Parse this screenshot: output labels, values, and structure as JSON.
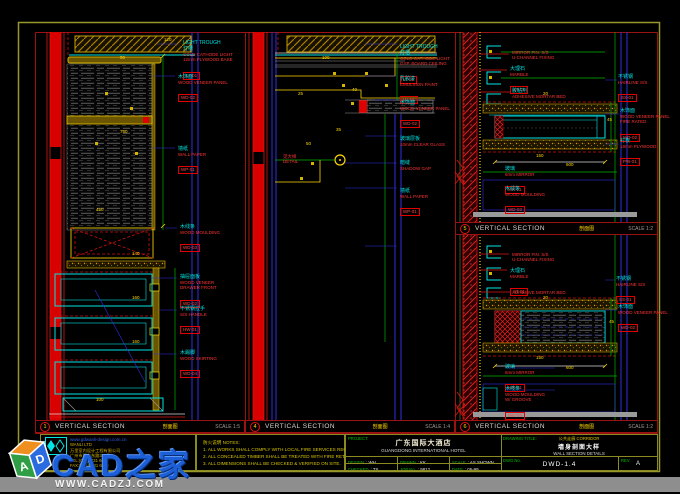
{
  "sheet": {
    "border_color": "#97972a",
    "separator_color": "#9b1212",
    "accent_red": "#e01414",
    "accent_cyan": "#00e5e5",
    "accent_yellow": "#ffd700",
    "accent_blue": "#2f2fe6"
  },
  "panels": [
    {
      "id": "1",
      "title": "VERTICAL SECTION",
      "subtitle": "剖面图",
      "scale": "SCALE 1:5",
      "callouts": [
        {
          "x": 183,
          "y": 40,
          "t": "LIGHT TROUGH\n灯槽",
          "r": "COLD CATHODE LIGHT\n12mm PLYWOOD BASE",
          "code": "LT-01"
        },
        {
          "x": 178,
          "y": 74,
          "t": "木饰面",
          "r": "WOOD VENEER PANEL",
          "code": "WD-02"
        },
        {
          "x": 178,
          "y": 146,
          "t": "墙纸",
          "r": "WALL PAPER",
          "code": "WP-01"
        },
        {
          "x": 180,
          "y": 224,
          "t": "木线条",
          "r": "WOOD MOULDING",
          "code": "WD-03"
        },
        {
          "x": 180,
          "y": 274,
          "t": "抽屉面板",
          "r": "WOOD VENEER\nDRAWER FRONT",
          "code": "WD-02"
        },
        {
          "x": 180,
          "y": 306,
          "t": "不锈钢拉手",
          "r": "S/S HANDLE",
          "code": "HW-01"
        },
        {
          "x": 180,
          "y": 350,
          "t": "木踢脚",
          "r": "WOOD SKIRTING",
          "code": "WD-04"
        }
      ],
      "dims": [
        {
          "x": 120,
          "y": 56,
          "v": "50"
        },
        {
          "x": 120,
          "y": 130,
          "v": "750"
        },
        {
          "x": 164,
          "y": 38,
          "v": "120"
        },
        {
          "x": 96,
          "y": 208,
          "v": "450"
        },
        {
          "x": 132,
          "y": 252,
          "v": "140"
        },
        {
          "x": 132,
          "y": 296,
          "v": "160"
        },
        {
          "x": 132,
          "y": 340,
          "v": "160"
        },
        {
          "x": 96,
          "y": 398,
          "v": "100"
        }
      ]
    },
    {
      "id": "4",
      "title": "VERTICAL SECTION",
      "subtitle": "剖面图",
      "scale": "SCALE 1:4",
      "callouts": [
        {
          "x": 400,
          "y": 44,
          "t": "LIGHT TROUGH\n灯槽",
          "r": "COLD CATHODE LIGHT\nGYP. BOARD CEILING",
          "code": "LT-01"
        },
        {
          "x": 400,
          "y": 76,
          "t": "乳胶漆",
          "r": "EMULSION PAINT",
          "code": "PT-01"
        },
        {
          "x": 400,
          "y": 100,
          "t": "木饰面",
          "r": "WOOD VENEER PANEL",
          "code": "WD-02"
        },
        {
          "x": 400,
          "y": 136,
          "t": "玻璃层板",
          "r": "10mm CLEAR GLASS"
        },
        {
          "x": 400,
          "y": 160,
          "t": "暗缝",
          "r": "SHADOW GAP"
        },
        {
          "x": 400,
          "y": 188,
          "t": "墙纸",
          "r": "WALL PAPER",
          "code": "WP-01"
        },
        {
          "x": 283,
          "y": 154,
          "r": "见大样\nDETAIL"
        }
      ],
      "dims": [
        {
          "x": 298,
          "y": 92,
          "v": "25"
        },
        {
          "x": 322,
          "y": 56,
          "v": "100"
        },
        {
          "x": 352,
          "y": 88,
          "v": "40"
        },
        {
          "x": 336,
          "y": 128,
          "v": "35"
        },
        {
          "x": 306,
          "y": 142,
          "v": "50"
        }
      ]
    },
    {
      "id": "5",
      "title": "VERTICAL SECTION",
      "subtitle": "剖面图",
      "scale": "SCALE 1:2",
      "callouts": [
        {
          "x": 512,
          "y": 50,
          "r": "MIRROR FIN. S/S\nU-CHANNEL FIXING"
        },
        {
          "x": 510,
          "y": 66,
          "t": "大理石",
          "r": "MARBLE",
          "code": "ST-01"
        },
        {
          "x": 512,
          "y": 88,
          "t": "胶粘剂",
          "r": "ADHESIVE MORTAR BED"
        },
        {
          "x": 618,
          "y": 74,
          "t": "不锈钢",
          "r": "HAIRLINE S/S",
          "code": "SS-01"
        },
        {
          "x": 620,
          "y": 108,
          "t": "木饰面",
          "r": "WOOD VENEER PANEL\nFIRE RATED",
          "code": "WD-02"
        },
        {
          "x": 620,
          "y": 138,
          "t": "衬板",
          "r": "18mm PLYWOOD",
          "code": "PW-01"
        },
        {
          "x": 505,
          "y": 166,
          "t": "玻璃",
          "r": "6mm MIRROR",
          "code": "MR-01"
        },
        {
          "x": 505,
          "y": 186,
          "t": "木线条",
          "r": "WOOD MOULDING",
          "code": "WD-03"
        }
      ],
      "dims": [
        {
          "x": 536,
          "y": 154,
          "v": "150"
        },
        {
          "x": 566,
          "y": 163,
          "v": "600"
        },
        {
          "x": 607,
          "y": 118,
          "v": "45"
        },
        {
          "x": 543,
          "y": 92,
          "v": "20"
        }
      ]
    },
    {
      "id": "6",
      "title": "VERTICAL SECTION",
      "subtitle": "剖面图",
      "scale": "SCALE 1:2",
      "callouts": [
        {
          "x": 512,
          "y": 252,
          "r": "MIRROR FIN. S/S\nU-CHANNEL FIXING"
        },
        {
          "x": 510,
          "y": 268,
          "t": "大理石",
          "r": "MARBLE",
          "code": "ST-01"
        },
        {
          "x": 512,
          "y": 290,
          "r": "ADHESIVE MORTAR BED"
        },
        {
          "x": 616,
          "y": 276,
          "t": "不锈钢",
          "r": "HAIRLINE S/S",
          "code": "SS-01"
        },
        {
          "x": 618,
          "y": 304,
          "t": "木饰面",
          "r": "WOOD VENEER PANEL",
          "code": "WD-02"
        },
        {
          "x": 505,
          "y": 364,
          "t": "玻璃",
          "r": "6mm MIRROR",
          "code": "MR-01"
        },
        {
          "x": 505,
          "y": 386,
          "t": "木线条",
          "r": "WOOD MOULDING\nW/ GROOVE",
          "code": "WD-03"
        }
      ],
      "dims": [
        {
          "x": 536,
          "y": 356,
          "v": "150"
        },
        {
          "x": 566,
          "y": 366,
          "v": "600"
        },
        {
          "x": 609,
          "y": 320,
          "v": "45"
        },
        {
          "x": 543,
          "y": 296,
          "v": "20"
        }
      ]
    }
  ],
  "logo_block": {
    "url": "www.gdwanli-design.com.cn",
    "company_lines": [
      "WANLI LTD",
      "万里室内设计工程有限公司",
      "广州市环市东路339号",
      "TEL:(020)8331 6688",
      "FAX:(020)8331 6689"
    ]
  },
  "notes": {
    "lines": [
      "防火说明 NOTES:",
      "1. ALL WORKS SHALL COMPLY WITH LOCAL FIRE SERVICES REGULATIONS.",
      "2. ALL CONCEALED TIMBER SHALL BE TREATED WITH FIRE RETARDANT PAINT.",
      "3. ALL DIMENSIONS SHALL BE CHECKED & VERIFIED ON SITE."
    ]
  },
  "titleblock": {
    "project": {
      "label": "PROJECT:",
      "cn": "广东国际大酒店",
      "en": "GUANGDONG INTERNATIONAL HOTEL"
    },
    "drawing": {
      "label": "DRAWING TITLE:",
      "small": "公共走廊 CORRIDOR",
      "cn": "墙身剖面大样",
      "en": "WALL SECTION DETAILS"
    },
    "r1": [
      {
        "label": "DESIGN",
        "value": ": WH"
      },
      {
        "label": "DRAWN",
        "value": ": KK"
      },
      {
        "label": "SCALE",
        "value": ": AS SHOWN"
      }
    ],
    "r2": [
      {
        "label": "CHECKED",
        "value": ": TS"
      },
      {
        "label": "JOB No.",
        "value": ": 9812"
      },
      {
        "label": "DATE",
        "value": ": 05-99"
      }
    ],
    "dwg": {
      "label": "DWG No.",
      "value": "DWD-1.4"
    },
    "rev": {
      "label": "REV",
      "value": "A"
    }
  },
  "watermark": {
    "logo_text": "CAD之家",
    "cube_left": "A",
    "cube_right": "D"
  },
  "footer": {
    "site_bar": "WWW.CADZJ.COM"
  }
}
